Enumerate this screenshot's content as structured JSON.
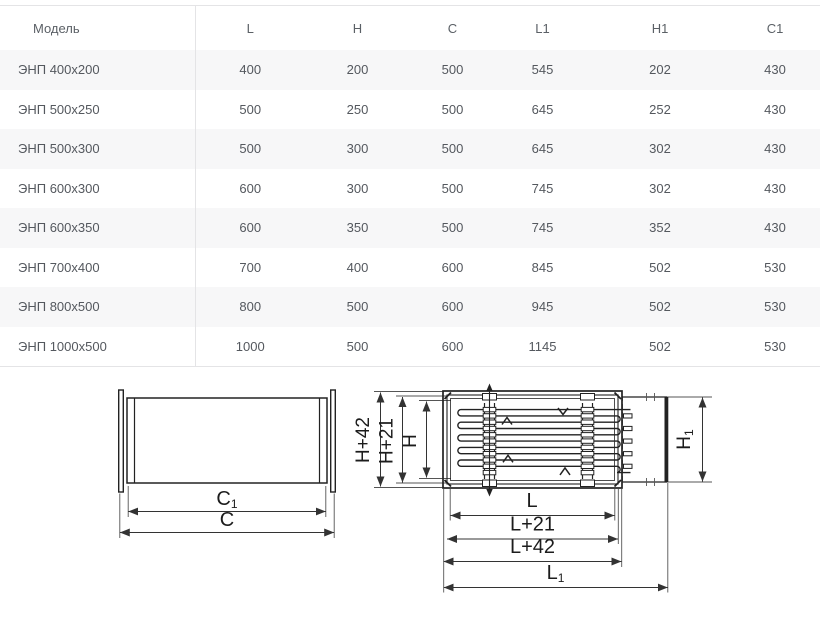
{
  "table": {
    "columns": [
      "Модель",
      "L",
      "H",
      "C",
      "L1",
      "H1",
      "C1"
    ],
    "rows": [
      [
        "ЭНП 400x200",
        "400",
        "200",
        "500",
        "545",
        "202",
        "430"
      ],
      [
        "ЭНП 500x250",
        "500",
        "250",
        "500",
        "645",
        "252",
        "430"
      ],
      [
        "ЭНП 500x300",
        "500",
        "300",
        "500",
        "645",
        "302",
        "430"
      ],
      [
        "ЭНП 600x300",
        "600",
        "300",
        "500",
        "745",
        "302",
        "430"
      ],
      [
        "ЭНП 600x350",
        "600",
        "350",
        "500",
        "745",
        "352",
        "430"
      ],
      [
        "ЭНП 700x400",
        "700",
        "400",
        "600",
        "845",
        "502",
        "530"
      ],
      [
        "ЭНП 800x500",
        "800",
        "500",
        "600",
        "945",
        "502",
        "530"
      ],
      [
        "ЭНП 1000x500",
        "1000",
        "500",
        "600",
        "1145",
        "502",
        "530"
      ]
    ]
  },
  "diagrams": {
    "side_view": {
      "dim_c1": {
        "base": "C",
        "sub": "1"
      },
      "dim_c": "C"
    },
    "top_view": {
      "dim_h42": "H+42",
      "dim_h21": "H+21",
      "dim_h": "H",
      "dim_h1": {
        "base": "H",
        "sub": "1"
      },
      "dim_l": "L",
      "dim_l21": "L+21",
      "dim_l42": "L+42",
      "dim_l1": {
        "base": "L",
        "sub": "1"
      }
    }
  },
  "colors": {
    "row_stripe": "#f7f7f8",
    "table_border": "#e4e4e6",
    "header_text": "#5b6066",
    "cell_text": "#54585e",
    "drawing_line": "#222222"
  }
}
